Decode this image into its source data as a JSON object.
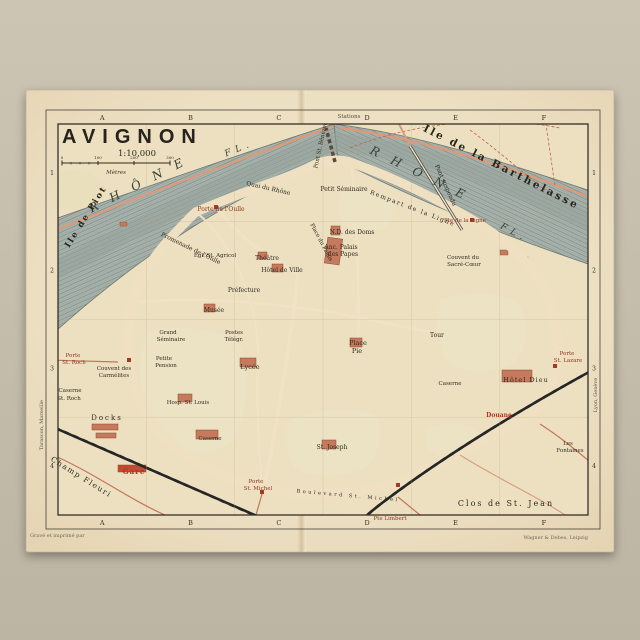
{
  "map": {
    "title": "AVIGNON",
    "scale_text": "1:10,000",
    "scale_unit": "Mètres",
    "scale_ticks": [
      "0",
      "100",
      "200",
      "300"
    ],
    "grid": {
      "columns": [
        "A",
        "B",
        "C",
        "D",
        "E",
        "F"
      ],
      "rows": [
        "1",
        "2",
        "3",
        "4"
      ]
    },
    "attribution_left": "Gravé et imprimé par",
    "attribution_right": "Wagner & Debes, Leipzig",
    "colors": {
      "paper": "#ecdfc2",
      "photo_background": "#c3bcab",
      "river": "#a9b4ae",
      "city_blocks": "#e0ac92",
      "landmark": "#c5795d",
      "garden_dots": "#8aa05f",
      "wall": "#93503a",
      "gate_text": "#8e3420",
      "label_ink": "#2f2a20"
    },
    "labels": [
      {
        "t": "R H Ô N E",
        "x": 140,
        "y": 188,
        "s": 12,
        "r": -27,
        "c": "river",
        "ls": 6
      },
      {
        "t": "FL.",
        "x": 240,
        "y": 151,
        "s": 9,
        "r": -22,
        "c": "river"
      },
      {
        "t": "R H Ô N E",
        "x": 418,
        "y": 177,
        "s": 12,
        "r": 26,
        "c": "river",
        "ls": 6
      },
      {
        "t": "FL.",
        "x": 513,
        "y": 235,
        "s": 9,
        "r": 28,
        "c": "river"
      },
      {
        "t": "Ile de Piot",
        "x": 88,
        "y": 218,
        "s": 8.5,
        "r": -58,
        "c": "island",
        "ls": 2
      },
      {
        "t": "Ile de la Barthelasse",
        "x": 500,
        "y": 170,
        "s": 10.5,
        "r": 27,
        "c": "island",
        "ls": 2.5
      },
      {
        "t": "Pont suspendu",
        "x": 444,
        "y": 186,
        "s": 6,
        "r": 66,
        "c": "place"
      },
      {
        "t": "Stations",
        "x": 349,
        "y": 118,
        "s": 5.5,
        "c": "tiny"
      },
      {
        "t": "Quai du Rhône",
        "x": 268,
        "y": 190,
        "s": 6,
        "r": 13,
        "c": "place"
      },
      {
        "t": "Rempart de la Ligne",
        "x": 412,
        "y": 210,
        "s": 6,
        "r": 21,
        "c": "place",
        "ls": 1.5
      },
      {
        "t": "Promenade de l'Oulle",
        "x": 190,
        "y": 250,
        "s": 6,
        "r": 26,
        "c": "place"
      },
      {
        "t": "Pont St. Bénézet",
        "x": 322,
        "y": 146,
        "s": 5.5,
        "r": -78,
        "c": "place"
      },
      {
        "t": "Porte de l'Oulle",
        "x": 221,
        "y": 211,
        "s": 6,
        "c": "gate"
      },
      {
        "t": "Petit Séminaire",
        "x": 344,
        "y": 191,
        "s": 6,
        "c": "place"
      },
      {
        "t": "N.D. des Doms",
        "x": 352,
        "y": 234,
        "s": 6,
        "c": "place"
      },
      {
        "t": "Anc. Palais",
        "x": 341,
        "y": 249,
        "s": 6,
        "c": "place"
      },
      {
        "t": "des Papes",
        "x": 343,
        "y": 256,
        "s": 6,
        "c": "place"
      },
      {
        "t": "Place du Palais",
        "x": 320,
        "y": 243,
        "s": 5.5,
        "r": 62,
        "c": "place"
      },
      {
        "t": "Couvent du",
        "x": 463,
        "y": 259,
        "s": 5.5,
        "c": "place"
      },
      {
        "t": "Sacré-Cœur",
        "x": 464,
        "y": 266,
        "s": 5.5,
        "c": "place"
      },
      {
        "t": "Pte de la Ligne",
        "x": 465,
        "y": 222,
        "s": 5.5,
        "c": "gate"
      },
      {
        "t": "Égl. St. Agricol",
        "x": 215,
        "y": 257,
        "s": 5.5,
        "c": "place"
      },
      {
        "t": "Théâtre",
        "x": 267,
        "y": 260,
        "s": 6,
        "c": "place"
      },
      {
        "t": "Hôtel de Ville",
        "x": 282,
        "y": 272,
        "s": 6,
        "c": "place"
      },
      {
        "t": "Préfecture",
        "x": 244,
        "y": 292,
        "s": 6,
        "c": "place"
      },
      {
        "t": "Musée",
        "x": 214,
        "y": 312,
        "s": 6,
        "c": "place"
      },
      {
        "t": "Place",
        "x": 358,
        "y": 345,
        "s": 6.5,
        "c": "place"
      },
      {
        "t": "Pie",
        "x": 357,
        "y": 353,
        "s": 6.5,
        "c": "place"
      },
      {
        "t": "Tour",
        "x": 437,
        "y": 337,
        "s": 6,
        "c": "place"
      },
      {
        "t": "Hôtel Dieu",
        "x": 526,
        "y": 382,
        "s": 6.5,
        "c": "place",
        "ls": 1
      },
      {
        "t": "Porte",
        "x": 567,
        "y": 355,
        "s": 5.5,
        "c": "gate"
      },
      {
        "t": "St. Lazare",
        "x": 568,
        "y": 362,
        "s": 5.5,
        "c": "gate"
      },
      {
        "t": "Porte",
        "x": 73,
        "y": 357,
        "s": 5.5,
        "c": "gate"
      },
      {
        "t": "St. Roch",
        "x": 74,
        "y": 364,
        "s": 5.5,
        "c": "gate"
      },
      {
        "t": "Couvent des",
        "x": 114,
        "y": 370,
        "s": 5.5,
        "c": "place"
      },
      {
        "t": "Carmélites",
        "x": 114,
        "y": 377,
        "s": 5.5,
        "c": "place"
      },
      {
        "t": "Caserne",
        "x": 70,
        "y": 392,
        "s": 5.5,
        "c": "place"
      },
      {
        "t": "St. Roch",
        "x": 69,
        "y": 400,
        "s": 5.5,
        "c": "place"
      },
      {
        "t": "Docks",
        "x": 107,
        "y": 420,
        "s": 7,
        "c": "place",
        "ls": 2
      },
      {
        "t": "Grand",
        "x": 168,
        "y": 334,
        "s": 5.5,
        "c": "place"
      },
      {
        "t": "Séminaire",
        "x": 171,
        "y": 341,
        "s": 5.5,
        "c": "place"
      },
      {
        "t": "Petite",
        "x": 164,
        "y": 360,
        "s": 5.5,
        "c": "place"
      },
      {
        "t": "Pension",
        "x": 166,
        "y": 367,
        "s": 5.5,
        "c": "place"
      },
      {
        "t": "Hosp. St. Louis",
        "x": 188,
        "y": 404,
        "s": 5.5,
        "c": "place"
      },
      {
        "t": "Lycée",
        "x": 250,
        "y": 369,
        "s": 6.5,
        "c": "place"
      },
      {
        "t": "Postes",
        "x": 234,
        "y": 334,
        "s": 5.5,
        "c": "place"
      },
      {
        "t": "Télégr.",
        "x": 234,
        "y": 341,
        "s": 5.5,
        "c": "place"
      },
      {
        "t": "Caserne",
        "x": 210,
        "y": 440,
        "s": 5.5,
        "c": "place"
      },
      {
        "t": "Gare",
        "x": 134,
        "y": 474,
        "s": 7,
        "c": "red",
        "ls": 1
      },
      {
        "t": "St. Joseph",
        "x": 332,
        "y": 449,
        "s": 6,
        "c": "place"
      },
      {
        "t": "Porte",
        "x": 256,
        "y": 483,
        "s": 5.5,
        "c": "gate"
      },
      {
        "t": "St. Michel",
        "x": 258,
        "y": 490,
        "s": 5.5,
        "c": "gate"
      },
      {
        "t": "Boulevard St. Michel",
        "x": 348,
        "y": 497,
        "s": 5,
        "r": 5,
        "c": "place",
        "ls": 2.5
      },
      {
        "t": "Pte Limbert",
        "x": 390,
        "y": 520,
        "s": 5.5,
        "c": "gate"
      },
      {
        "t": "Clos de St. Jean",
        "x": 506,
        "y": 506,
        "s": 8,
        "c": "place",
        "ls": 2
      },
      {
        "t": "Champ Fleuri",
        "x": 80,
        "y": 479,
        "s": 7.5,
        "r": 32,
        "c": "place",
        "ls": 1.5
      },
      {
        "t": "Douane",
        "x": 499,
        "y": 417,
        "s": 6,
        "c": "red"
      },
      {
        "t": "Les",
        "x": 568,
        "y": 445,
        "s": 5.5,
        "c": "place"
      },
      {
        "t": "Fontaines",
        "x": 570,
        "y": 452,
        "s": 5.5,
        "c": "place"
      },
      {
        "t": "Caserne",
        "x": 450,
        "y": 385,
        "s": 5.5,
        "c": "place"
      },
      {
        "t": "Tarascon, Marseille",
        "x": 43,
        "y": 425,
        "s": 5,
        "r": -90,
        "c": "tiny"
      },
      {
        "t": "Lyon, Genève",
        "x": 597,
        "y": 395,
        "s": 5,
        "r": -90,
        "c": "tiny"
      }
    ]
  }
}
